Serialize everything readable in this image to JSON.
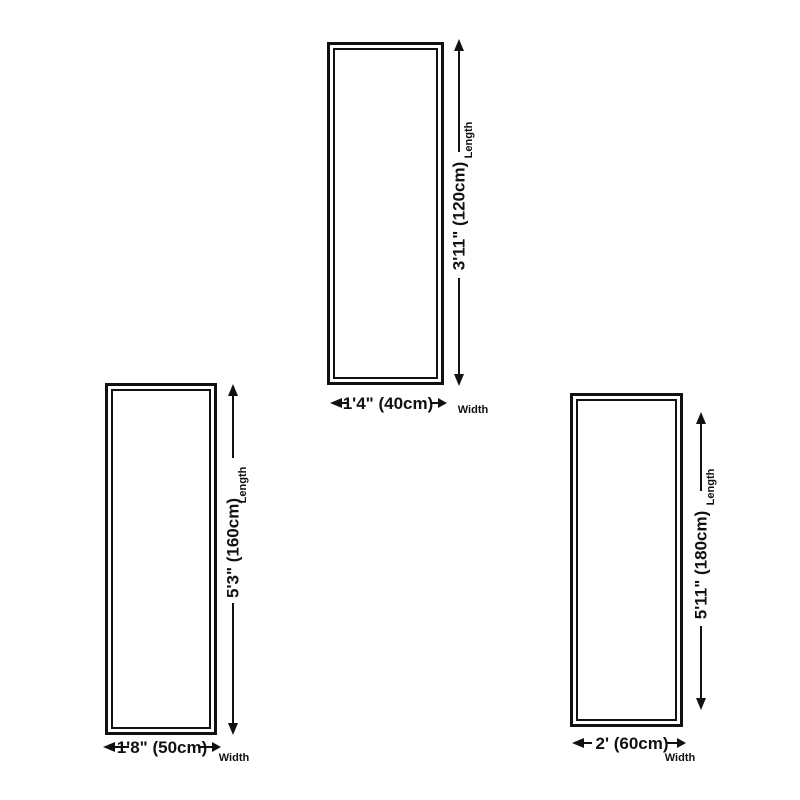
{
  "canvas": {
    "background": "#ffffff",
    "ink": "#111111"
  },
  "diagrams": [
    {
      "name": "size-box-120cm",
      "length_label": "3'11\" (120cm)",
      "length_caption": "Length",
      "width_label": "1'4\" (40cm)",
      "width_caption": "Width"
    },
    {
      "name": "size-box-160cm",
      "length_label": "5'3\" (160cm)",
      "length_caption": "Length",
      "width_label": "1'8\" (50cm)",
      "width_caption": "Width"
    },
    {
      "name": "size-box-180cm",
      "length_label": "5'11\" (180cm)",
      "length_caption": "Length",
      "width_label": "2' (60cm)",
      "width_caption": "Width"
    }
  ]
}
